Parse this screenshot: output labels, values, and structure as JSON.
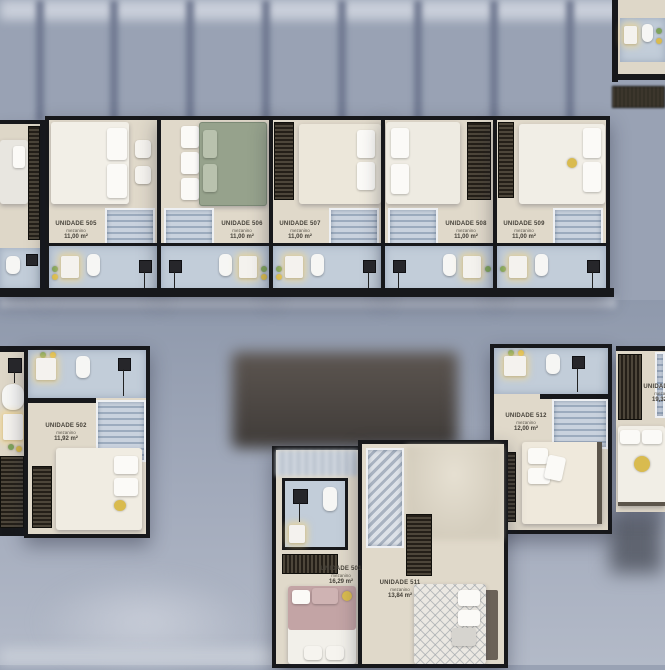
{
  "palette": {
    "wall": "#17181b",
    "floor": "#ded7c8",
    "bathroom_floor": "#c2cdd9",
    "stairs": "#b7c3d1",
    "background": "#99a2b4",
    "accent_yellow": "#d9bb4f",
    "plant_green": "#7fa35c",
    "bed_white": "#f1eee6",
    "bed_green": "#96a28c",
    "bed_mauve": "#c3a4a5"
  },
  "units": [
    {
      "id": "505",
      "name": "UNIDADE 505",
      "level": "mezanino",
      "area": "11,00 m²"
    },
    {
      "id": "506",
      "name": "UNIDADE 506",
      "level": "mezanino",
      "area": "11,00 m²"
    },
    {
      "id": "507",
      "name": "UNIDADE 507",
      "level": "mezanino",
      "area": "11,00 m²"
    },
    {
      "id": "508",
      "name": "UNIDADE 508",
      "level": "mezanino",
      "area": "11,00 m²"
    },
    {
      "id": "509",
      "name": "UNIDADE 509",
      "level": "mezanino",
      "area": "11,00 m²"
    },
    {
      "id": "502",
      "name": "UNIDADE 502",
      "level": "mezanino",
      "area": "11,92 m²"
    },
    {
      "id": "512",
      "name": "UNIDADE 512",
      "level": "mezanino",
      "area": "12,00 m²"
    },
    {
      "id": "513",
      "name": "UNIDADE 513",
      "level": "mezanino",
      "area": "19,32 m²"
    },
    {
      "id": "501",
      "name": "UNIDADE 501",
      "level": "mezanino",
      "area": "16,29 m²"
    },
    {
      "id": "511",
      "name": "UNIDADE 511",
      "level": "mezanino",
      "area": "13,84 m²"
    }
  ]
}
